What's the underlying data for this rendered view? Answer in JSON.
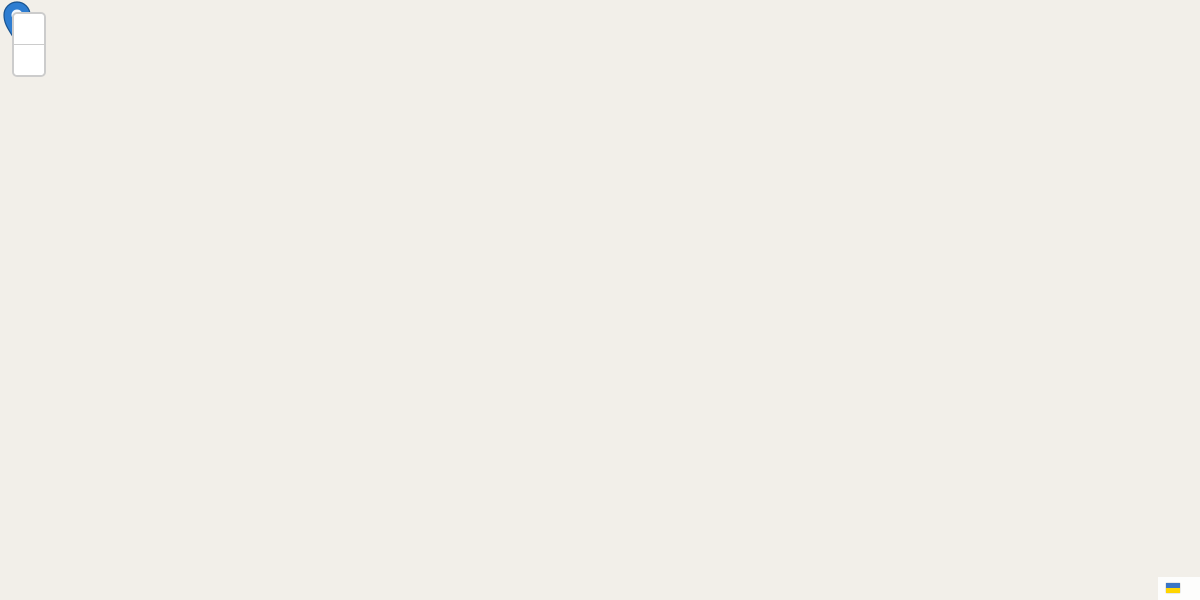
{
  "controls": {
    "zoom_in": "+",
    "zoom_out": "−"
  },
  "attribution": {
    "leaflet": "Leaflet",
    "sep": "|",
    "copyright": "© OpenStreetMap"
  },
  "marker": {
    "x": 918,
    "y": 150,
    "label": "CTT"
  },
  "colors": {
    "highlight_fill": "#e3525c",
    "cell_stroke": "#3a6291",
    "marker_blue": "#2e7dd1"
  },
  "streets": [
    {
      "t": "Travessa Rebelo da Silva",
      "x": 690,
      "y": 13,
      "r": -5
    },
    {
      "t": "Rua Pascoal de Melo",
      "x": 378,
      "y": 112,
      "r": -7
    },
    {
      "t": "Rua Aquiles Monteverde",
      "x": 722,
      "y": 116,
      "r": 7
    },
    {
      "t": "Rua Pascoal de Melo",
      "x": 980,
      "y": 179,
      "r": 4
    },
    {
      "t": "Rua Pascoal de Melo",
      "x": 1146,
      "y": 196,
      "r": 5
    },
    {
      "t": "Rua da Ilha do Pico",
      "x": 366,
      "y": 46,
      "r": -70
    },
    {
      "t": "Rua de Arroios",
      "x": 856,
      "y": 46,
      "r": 70
    },
    {
      "t": "Rua de Arroios",
      "x": 927,
      "y": 432,
      "r": 86
    },
    {
      "t": "Vila Luz",
      "x": 271,
      "y": 234,
      "r": -4
    },
    {
      "t": "Rua Alexandre Braga",
      "x": 447,
      "y": 337,
      "r": -5
    },
    {
      "t": "Rua Mindelo",
      "x": 712,
      "y": 355,
      "r": 3
    },
    {
      "t": "Rua José Estevão",
      "x": 636,
      "y": 272,
      "r": 88
    },
    {
      "t": "Rua de Dona Estefânia",
      "x": 73,
      "y": 333,
      "r": 71
    },
    {
      "t": "Travessa da Escola Araújo",
      "x": 256,
      "y": 563,
      "r": -3
    }
  ],
  "pois": [
    {
      "t": "Floresta\nda Estefânia",
      "x": 300,
      "y": 9,
      "c": "shop"
    },
    {
      "t": "Ráffcs\nBagels",
      "x": 150,
      "y": 84,
      "c": "food"
    },
    {
      "t": "Tons de\nBanho",
      "x": 268,
      "y": 94,
      "c": "shop"
    },
    {
      "t": "Amma\nLisboa\nHotel",
      "x": 233,
      "y": 106,
      "c": "hotel"
    },
    {
      "t": "Zagarino",
      "x": 230,
      "y": 147,
      "c": "food"
    },
    {
      "t": "Atithi",
      "x": 278,
      "y": 146,
      "c": "food"
    },
    {
      "t": "Lineacasa",
      "x": 317,
      "y": 148,
      "c": "shop"
    },
    {
      "t": "A minha\nfilhota",
      "x": 412,
      "y": 168,
      "c": "shop"
    },
    {
      "t": "Fitness\nUp",
      "x": 512,
      "y": 178,
      "c": "fit"
    },
    {
      "t": "Wine Hunters",
      "x": 470,
      "y": 110,
      "c": "food"
    },
    {
      "t": "Edimel",
      "x": 781,
      "y": 97,
      "c": "hotel"
    },
    {
      "t": "Loja Chinesa",
      "x": 196,
      "y": 196,
      "c": "shop"
    },
    {
      "t": "Humana",
      "x": 81,
      "y": 246,
      "c": "shop"
    },
    {
      "t": "Aldi\nEstefânia\nShopping",
      "x": 100,
      "y": 297,
      "c": "shop"
    },
    {
      "t": "Henar",
      "x": 26,
      "y": 296,
      "c": "shop"
    },
    {
      "t": "Café Restaurante\nNovos",
      "x": 296,
      "y": 311,
      "c": "food"
    },
    {
      "t": "O Luciano",
      "x": 177,
      "y": 369,
      "c": "food"
    },
    {
      "t": "Café Ponto\nde Encontro",
      "x": 236,
      "y": 372,
      "c": "food"
    },
    {
      "t": "ZABRA",
      "x": 404,
      "y": 371,
      "c": "zabra"
    },
    {
      "t": "Villa\nHelena",
      "x": 461,
      "y": 450,
      "c": "place"
    },
    {
      "t": "Colégio\nMãe\nMaria",
      "x": 272,
      "y": 478,
      "c": "place"
    },
    {
      "t": "Narz Home",
      "x": 131,
      "y": 476,
      "c": "shop"
    },
    {
      "t": "Slash",
      "x": 62,
      "y": 474,
      "c": "shop"
    },
    {
      "t": "Moments\nLetter",
      "x": 613,
      "y": 299,
      "c": "shop"
    },
    {
      "t": "Doces\ncom História",
      "x": 614,
      "y": 367,
      "c": "shop"
    },
    {
      "t": "Pastelaria\nSanta Cruz",
      "x": 611,
      "y": 405,
      "c": "food"
    },
    {
      "t": "Mostarda",
      "x": 714,
      "y": 297,
      "c": "garden"
    },
    {
      "t": "Loja Chinesa",
      "x": 797,
      "y": 206,
      "c": "shop"
    },
    {
      "t": "Lisbon\nVegan",
      "x": 848,
      "y": 232,
      "c": "food"
    },
    {
      "t": "Hotel Luena",
      "x": 978,
      "y": 233,
      "c": "hotel"
    },
    {
      "t": "O Telheirinho",
      "x": 871,
      "y": 320,
      "c": "food"
    },
    {
      "t": "Dedalmania",
      "x": 805,
      "y": 331,
      "c": "shop"
    },
    {
      "t": "Zénite\nBar Galeria",
      "x": 801,
      "y": 378,
      "c": "shop"
    },
    {
      "t": "4 Assure",
      "x": 877,
      "y": 372,
      "c": "shop"
    },
    {
      "t": "Socontas",
      "x": 942,
      "y": 371,
      "c": "blue"
    },
    {
      "t": "Franguinho\nReal",
      "x": 887,
      "y": 401,
      "c": "shop"
    },
    {
      "t": "Manuel\nde Arroios",
      "x": 898,
      "y": 487,
      "c": "shop"
    },
    {
      "t": "Deriva\nFórmula",
      "x": 893,
      "y": 556,
      "c": "shop"
    },
    {
      "t": "Mr Lu",
      "x": 1018,
      "y": 555,
      "c": "food"
    },
    {
      "t": "Bicicletas",
      "x": 1013,
      "y": 591,
      "c": "blue"
    },
    {
      "t": "Centro\nComercial\nPortugália",
      "x": 1122,
      "y": 537,
      "c": "place"
    },
    {
      "t": "Cervejaria\nPortugália",
      "x": 1170,
      "y": 265,
      "c": "food"
    },
    {
      "t": "Fabrica\nde Cerveja",
      "x": 1175,
      "y": 325,
      "c": "place"
    },
    {
      "t": "Artes d'Ontem",
      "x": 1139,
      "y": 181,
      "c": "shop"
    },
    {
      "t": "CTT",
      "x": 909,
      "y": 158,
      "c": "blue"
    },
    {
      "t": "Califa",
      "x": 1186,
      "y": 89,
      "c": "food"
    },
    {
      "t": "Du",
      "x": 1192,
      "y": 8,
      "c": "shop"
    },
    {
      "t": "do seco",
      "x": 882,
      "y": 4,
      "c": "shop"
    },
    {
      "t": "Edimel",
      "x": 682,
      "y": 539,
      "c": "shop"
    },
    {
      "t": "Bodyline",
      "x": 675,
      "y": 421,
      "c": "shop"
    },
    {
      "t": "Wingmotor",
      "x": 678,
      "y": 487,
      "c": "shop"
    },
    {
      "t": "Blue store\narroios",
      "x": 620,
      "y": 511,
      "c": "shop"
    },
    {
      "t": "Minimercado\nOliveiras",
      "x": 741,
      "y": 417,
      "c": "food"
    },
    {
      "t": "Pregas\ne Nervuras",
      "x": 743,
      "y": 504,
      "c": "shop"
    },
    {
      "t": "Henry\nSchein",
      "x": 744,
      "y": 570,
      "c": "shop"
    },
    {
      "t": "Fonte do\nNeptuno",
      "x": 40,
      "y": 113,
      "c": "water"
    }
  ],
  "numbers": [
    [
      602,
      215,
      "135-137"
    ],
    [
      613,
      236,
      "135A"
    ],
    [
      445,
      82,
      "76-92"
    ],
    [
      368,
      149,
      "79"
    ],
    [
      459,
      161,
      "67"
    ],
    [
      558,
      154,
      "45-37-29"
    ],
    [
      846,
      78,
      "32"
    ],
    [
      608,
      79,
      "32"
    ],
    [
      680,
      89,
      "26"
    ],
    [
      792,
      18,
      "221"
    ],
    [
      794,
      33,
      "219"
    ],
    [
      812,
      58,
      "217"
    ],
    [
      770,
      98,
      "10, 10A"
    ],
    [
      817,
      100,
      "2"
    ],
    [
      591,
      26,
      "2"
    ],
    [
      893,
      43,
      "164"
    ],
    [
      1048,
      23,
      "125"
    ],
    [
      1048,
      43,
      "123"
    ],
    [
      1043,
      68,
      "121"
    ],
    [
      1038,
      89,
      "119"
    ],
    [
      1037,
      116,
      "117"
    ],
    [
      967,
      136,
      "62"
    ],
    [
      1001,
      135,
      "60"
    ],
    [
      1120,
      17,
      "50"
    ],
    [
      1121,
      34,
      "48"
    ],
    [
      1117,
      82,
      "44"
    ],
    [
      1115,
      107,
      "42"
    ],
    [
      905,
      203,
      "13"
    ],
    [
      953,
      213,
      "11"
    ],
    [
      21,
      241,
      "125"
    ],
    [
      235,
      296,
      "22"
    ],
    [
      263,
      294,
      "20"
    ],
    [
      314,
      379,
      "36"
    ],
    [
      327,
      430,
      "34"
    ],
    [
      377,
      303,
      "12"
    ],
    [
      409,
      306,
      "10"
    ],
    [
      436,
      311,
      "8"
    ],
    [
      479,
      323,
      "6"
    ],
    [
      518,
      333,
      "4"
    ],
    [
      360,
      363,
      "19"
    ],
    [
      390,
      359,
      "17"
    ],
    [
      445,
      369,
      "13"
    ],
    [
      472,
      373,
      "11"
    ],
    [
      498,
      379,
      "9"
    ],
    [
      524,
      381,
      "7"
    ],
    [
      549,
      384,
      "5"
    ],
    [
      573,
      388,
      "3"
    ],
    [
      125,
      410,
      "24"
    ],
    [
      129,
      442,
      "22"
    ],
    [
      145,
      529,
      "16"
    ],
    [
      148,
      545,
      "14"
    ],
    [
      665,
      399,
      "80"
    ],
    [
      676,
      433,
      "76"
    ],
    [
      685,
      506,
      "72"
    ],
    [
      683,
      555,
      "60"
    ],
    [
      682,
      575,
      "54-58"
    ],
    [
      687,
      594,
      "48,50,52"
    ],
    [
      743,
      587,
      "69"
    ],
    [
      808,
      474,
      "104"
    ],
    [
      803,
      286,
      "124 A"
    ],
    [
      794,
      344,
      "116B"
    ],
    [
      812,
      400,
      "108A"
    ],
    [
      888,
      353,
      "127"
    ],
    [
      931,
      308,
      "120"
    ],
    [
      951,
      346,
      "118"
    ],
    [
      959,
      403,
      "100"
    ],
    [
      960,
      453,
      "96"
    ],
    [
      958,
      476,
      "94,92"
    ],
    [
      953,
      508,
      "90"
    ],
    [
      950,
      530,
      "88"
    ],
    [
      1018,
      431,
      "101"
    ],
    [
      1017,
      468,
      "99"
    ],
    [
      1011,
      513,
      "97"
    ],
    [
      889,
      518,
      "93"
    ],
    [
      1045,
      230,
      "BPI"
    ]
  ],
  "icon_groups": [
    {
      "name": "parking-icon",
      "glyph": "P",
      "fg": "#2b72bd",
      "fs": 11,
      "bold": true,
      "pts": [
        [
          104,
          68
        ],
        [
          342,
          98
        ],
        [
          587,
          12
        ],
        [
          696,
          63
        ],
        [
          786,
          118
        ],
        [
          864,
          20
        ],
        [
          940,
          177
        ],
        [
          893,
          284
        ],
        [
          262,
          457
        ],
        [
          180,
          320
        ],
        [
          105,
          374
        ],
        [
          845,
          508
        ],
        [
          933,
          565
        ],
        [
          73,
          458
        ],
        [
          1098,
          6
        ],
        [
          347,
          322
        ],
        [
          473,
          343
        ]
      ]
    },
    {
      "name": "cafe-icon",
      "glyph": "☕",
      "fg": "#a5671f",
      "fs": 10,
      "pts": [
        [
          448,
          87
        ],
        [
          150,
          57
        ],
        [
          160,
          310
        ],
        [
          197,
          306
        ],
        [
          175,
          352
        ],
        [
          230,
          343
        ],
        [
          45,
          378
        ],
        [
          715,
          285
        ],
        [
          1099,
          161
        ],
        [
          1161,
          165
        ],
        [
          873,
          120
        ],
        [
          913,
          265
        ],
        [
          803,
          447
        ],
        [
          135,
          597
        ]
      ]
    },
    {
      "name": "restaurant-icon",
      "glyph": "Ψ",
      "fg": "#c07a18",
      "fs": 10,
      "pts": [
        [
          233,
          130
        ],
        [
          275,
          127
        ],
        [
          470,
          93
        ],
        [
          767,
          43
        ],
        [
          850,
          222
        ],
        [
          870,
          304
        ],
        [
          1172,
          242
        ],
        [
          1015,
          541
        ],
        [
          63,
          457
        ]
      ]
    },
    {
      "name": "pharmacy-icon",
      "glyph": "+",
      "fg": "#ffffff",
      "bg": "#d43d3d",
      "box": 11,
      "fs": 10,
      "bold": true,
      "pts": [
        [
          537,
          24
        ],
        [
          712,
          17
        ],
        [
          677,
          390
        ],
        [
          67,
          489
        ]
      ]
    },
    {
      "name": "veterinary-icon",
      "glyph": "+",
      "fg": "#ffffff",
      "bg": "#b5454f",
      "box": 10,
      "fs": 9,
      "bold": true,
      "pts": [
        [
          859,
          267
        ]
      ]
    },
    {
      "name": "post-office-icon",
      "glyph": "✉",
      "fg": "#ffffff",
      "bg": "#7a4a35",
      "box": 14,
      "fs": 9,
      "pts": [
        [
          897,
          142
        ]
      ]
    },
    {
      "name": "bus-stop-icon",
      "glyph": "",
      "fg": "#ffffff",
      "bg": "#2f78c2",
      "box": 8,
      "pts": [
        [
          763,
          290
        ],
        [
          945,
          162
        ]
      ]
    },
    {
      "name": "clothes-shop-icon",
      "glyph": "T",
      "fg": "#ffffff",
      "bg": "#a849a8",
      "box": 9,
      "fs": 7,
      "bold": true,
      "pts": [
        [
          255,
          68
        ],
        [
          185,
          118
        ],
        [
          79,
          229
        ],
        [
          410,
          145
        ],
        [
          743,
          482
        ]
      ]
    },
    {
      "name": "shop-dot-icon",
      "glyph": "●",
      "fg": "#a849a8",
      "fs": 8,
      "pts": [
        [
          385,
          178
        ],
        [
          852,
          250
        ],
        [
          925,
          330
        ],
        [
          893,
          490
        ],
        [
          237,
          353
        ],
        [
          621,
          525
        ],
        [
          765,
          455
        ],
        [
          795,
          553
        ],
        [
          196,
          173
        ]
      ]
    },
    {
      "name": "fountain-icon",
      "glyph": "●",
      "fg": "#57707e",
      "fs": 9,
      "pts": [
        [
          62,
          118
        ]
      ]
    },
    {
      "name": "wheelchair-icon",
      "glyph": "♿",
      "fg": "#a849a8",
      "fs": 10,
      "pts": [
        [
          750,
          548
        ]
      ]
    },
    {
      "name": "oneway-right-icon",
      "glyph": "→",
      "fg": "#555555",
      "fs": 10,
      "pts": [
        [
          163,
          333
        ],
        [
          755,
          355
        ],
        [
          595,
          103
        ]
      ]
    },
    {
      "name": "oneway-down-icon",
      "glyph": "↓",
      "fg": "#555555",
      "fs": 10,
      "pts": [
        [
          638,
          196
        ],
        [
          645,
          444
        ]
      ]
    },
    {
      "name": "oneway-up-icon",
      "glyph": "↑",
      "fg": "#555555",
      "fs": 10,
      "pts": [
        [
          1080,
          95
        ],
        [
          777,
          528
        ]
      ]
    }
  ]
}
